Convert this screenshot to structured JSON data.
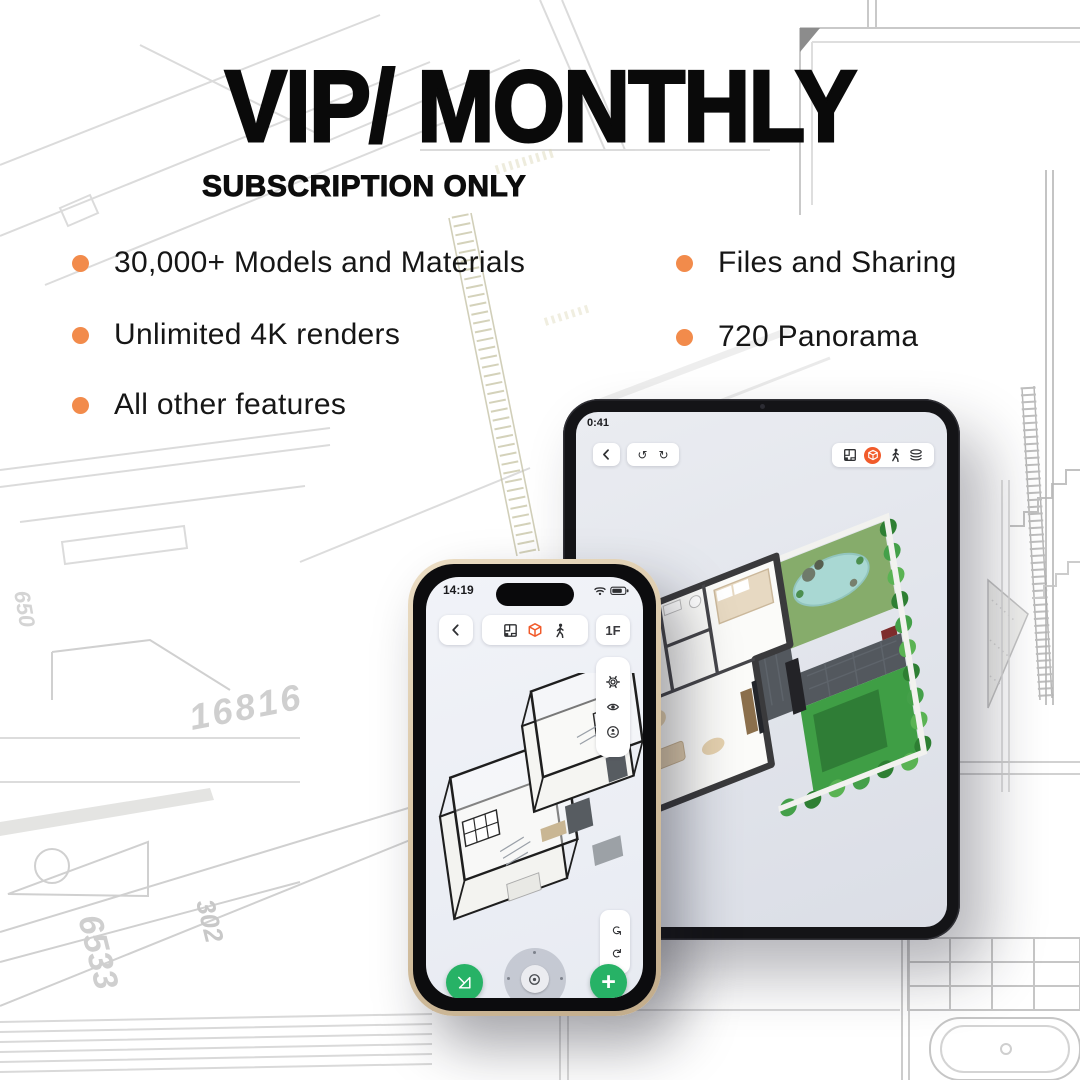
{
  "colors": {
    "accent": "#F28B4B",
    "app_orange": "#F15B2B",
    "green": "#27B266",
    "ink": "#0A0A0A"
  },
  "header": {
    "title": "VIP/ MONTHLY",
    "subtitle": "SUBSCRIPTION ONLY"
  },
  "features": {
    "left": [
      {
        "label": "30,000+ Models and Materials"
      },
      {
        "label": "Unlimited 4K renders"
      },
      {
        "label": "All other features"
      }
    ],
    "right": [
      {
        "label": "Files and Sharing"
      },
      {
        "label": "720 Panorama"
      }
    ]
  },
  "glyphs": {
    "undo": "↺",
    "redo": "↻",
    "plus": "+"
  },
  "phone": {
    "status_time": "14:19",
    "floor_button": "1F",
    "toolbar_icons": [
      "plan-2d",
      "cube-3d",
      "walk"
    ],
    "side_icons": [
      "settings-gear",
      "eye",
      "street-view"
    ],
    "history_icons": [
      "undo",
      "redo"
    ],
    "bottom_icons": [
      "set-square",
      "joystick",
      "add"
    ]
  },
  "tablet": {
    "status_time": "0:41",
    "toolbar_icons": [
      "plan-2d",
      "cube-3d",
      "walk",
      "layers"
    ],
    "history_icons": [
      "undo",
      "redo"
    ]
  },
  "background": {
    "labels": {
      "dim1": "16816",
      "dim2": "6533",
      "dim3": "302",
      "dim4": "650",
      "grid": "A"
    }
  }
}
